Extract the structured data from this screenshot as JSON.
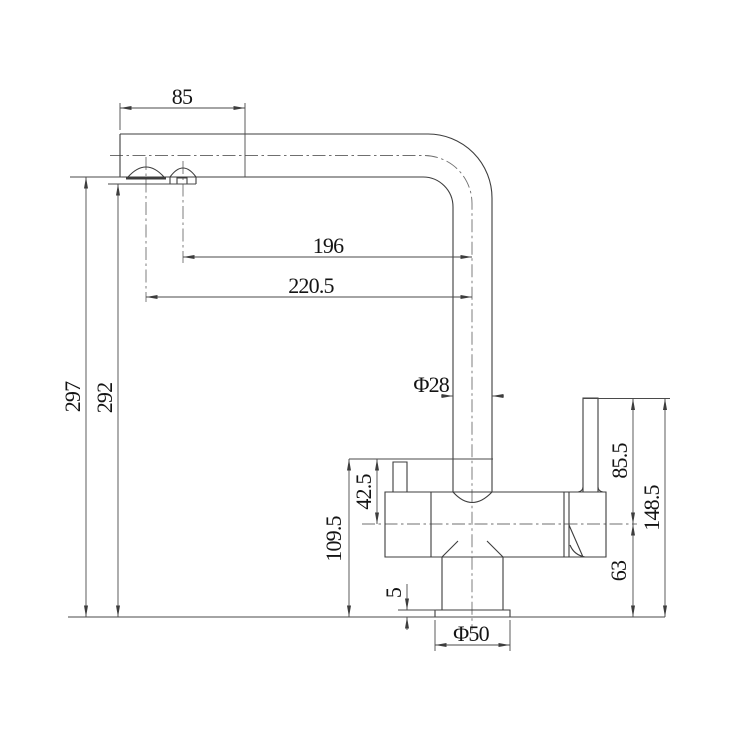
{
  "drawing": {
    "type": "faucet-technical-dimension-drawing",
    "background_color": "#ffffff",
    "line_color": "#3d3d3d",
    "centerline_color": "#6f6f6f",
    "text_color": "#141414",
    "dimensions": {
      "spout_top_offset": "85",
      "spout_reach_inner": "196",
      "spout_reach_outer": "220.5",
      "spout_height_outer": "297",
      "spout_height_inner": "292",
      "pipe_diameter": "Φ28",
      "outlet_stub_height": "42.5",
      "body_top_height": "109.5",
      "base_plate_thickness": "5",
      "base_diameter": "Φ50",
      "handle_above_center": "85.5",
      "center_above_base": "63",
      "handle_total_height": "148.5"
    }
  }
}
